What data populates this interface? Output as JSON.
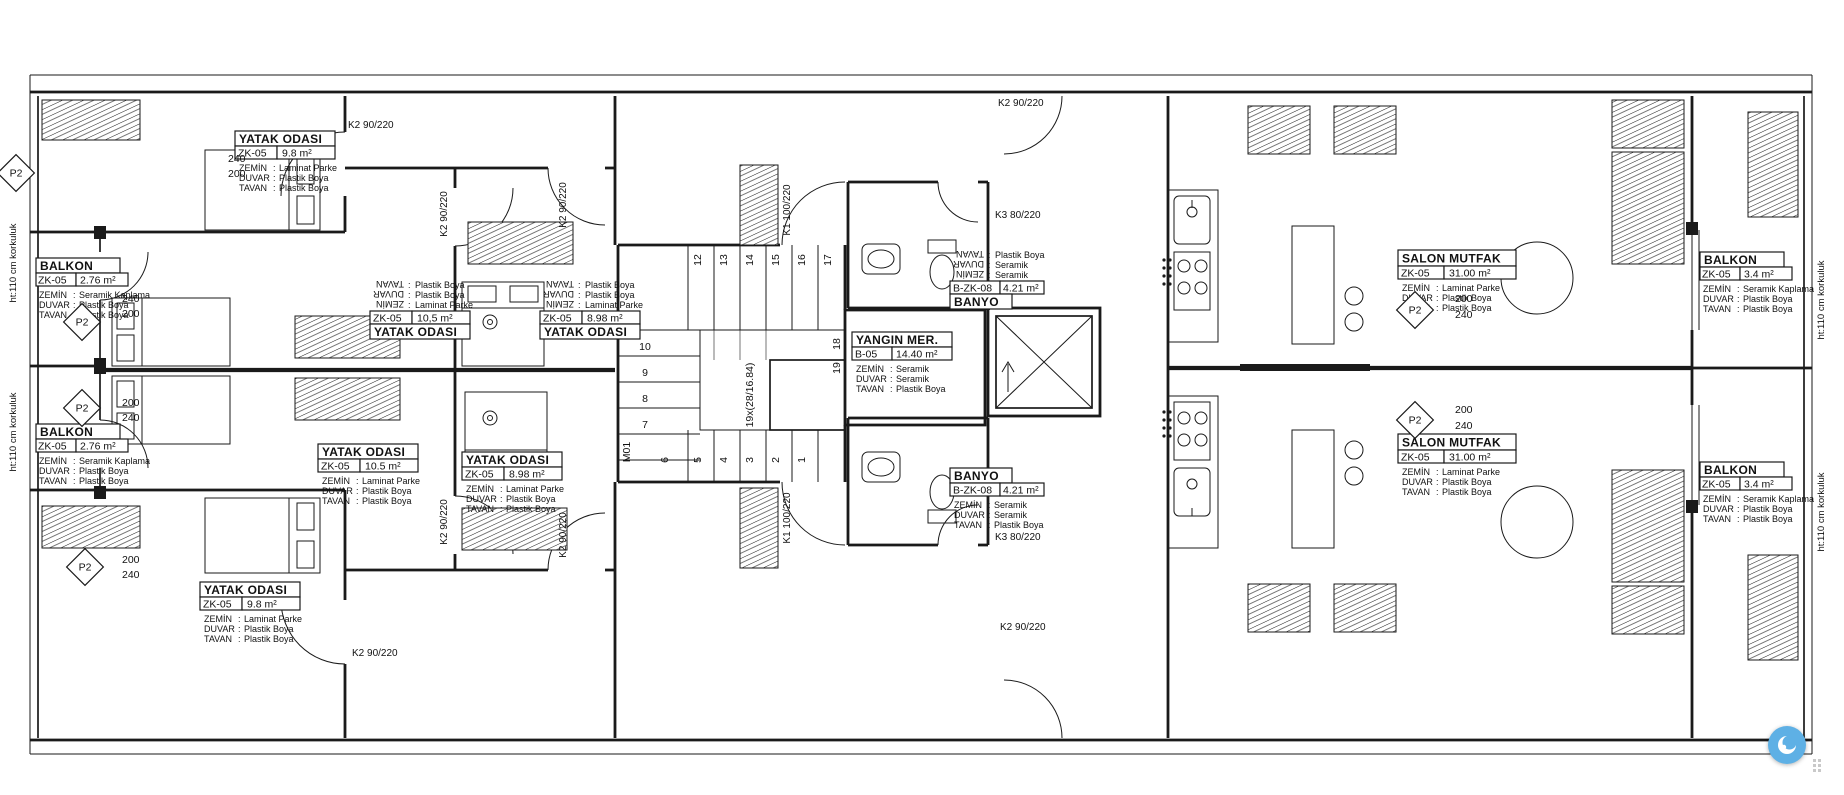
{
  "plan_title": "apartment floor plan",
  "colors": {
    "line": "#1a1a1a",
    "widget_accent": "#5eb0e5"
  },
  "field_labels": {
    "zemin": "ZEMİN",
    "duvar": "DUVAR",
    "tavan": "TAVAN",
    "colon": ":"
  },
  "rooms": [
    {
      "name": "YATAK ODASI",
      "code": "ZK-05",
      "area": "9.8 m²",
      "zemin": "Laminat Parke",
      "duvar": "Plastik Boya",
      "tavan": "Plastik Boya"
    },
    {
      "name": "BALKON",
      "code": "ZK-05",
      "area": "2.76 m²",
      "zemin": "Seramik Kaplama",
      "duvar": "Plastik Boya",
      "tavan": "Plastik Boya"
    },
    {
      "name": "YATAK ODASI",
      "code": "ZK-05",
      "area": "10,5 m²",
      "zemin": "Laminat Parke",
      "duvar": "Plastik Boya",
      "tavan": "Plastik Boya"
    },
    {
      "name": "YATAK ODASI",
      "code": "ZK-05",
      "area": "8.98 m²",
      "zemin": "Laminat Parke",
      "duvar": "Plastik Boya",
      "tavan": "Plastik Boya"
    },
    {
      "name": "BANYO",
      "code": "B-ZK-08",
      "area": "4.21 m²",
      "zemin": "Seramik",
      "duvar": "Seramik",
      "tavan": "Plastik Boya"
    },
    {
      "name": "YANGIN MER.",
      "code": "B-05",
      "area": "14.40 m²",
      "zemin": "Seramik",
      "duvar": "Seramik",
      "tavan": "Plastik Boya"
    },
    {
      "name": "SALON MUTFAK",
      "code": "ZK-05",
      "area": "31.00 m²",
      "zemin": "Laminat Parke",
      "duvar": "Plastik Boya",
      "tavan": "Plastik Boya"
    },
    {
      "name": "BALKON",
      "code": "ZK-05",
      "area": "3.4 m²",
      "zemin": "Seramik Kaplama",
      "duvar": "Plastik Boya",
      "tavan": "Plastik Boya"
    },
    {
      "name": "BALKON",
      "code": "ZK-05",
      "area": "2.76 m²",
      "zemin": "Seramik Kaplama",
      "duvar": "Plastik Boya",
      "tavan": "Plastik Boya"
    },
    {
      "name": "YATAK ODASI",
      "code": "ZK-05",
      "area": "10.5 m²",
      "zemin": "Laminat Parke",
      "duvar": "Plastik Boya",
      "tavan": "Plastik Boya"
    },
    {
      "name": "YATAK ODASI",
      "code": "ZK-05",
      "area": "8.98 m²",
      "zemin": "Laminat Parke",
      "duvar": "Plastik Boya",
      "tavan": "Plastik Boya"
    },
    {
      "name": "BANYO",
      "code": "B-ZK-08",
      "area": "4.21 m²",
      "zemin": "Seramik",
      "duvar": "Seramik",
      "tavan": "Plastik Boya"
    },
    {
      "name": "YATAK ODASI",
      "code": "ZK-05",
      "area": "9.8 m²",
      "zemin": "Laminat Parke",
      "duvar": "Plastik Boya",
      "tavan": "Plastik Boya"
    },
    {
      "name": "SALON MUTFAK",
      "code": "ZK-05",
      "area": "31.00 m²",
      "zemin": "Laminat Parke",
      "duvar": "Plastik Boya",
      "tavan": "Plastik Boya"
    },
    {
      "name": "BALKON",
      "code": "ZK-05",
      "area": "3.4 m²",
      "zemin": "Seramik Kaplama",
      "duvar": "Plastik Boya",
      "tavan": "Plastik Boya"
    }
  ],
  "doors": {
    "k2": "K2  90/220",
    "k1": "K1  100/220",
    "k3": "K3  80/220"
  },
  "dims": {
    "d240": "240",
    "d200": "200"
  },
  "stairs": {
    "note": "19x(28/16.84)",
    "m01": "M01",
    "top": [
      "12",
      "13",
      "14",
      "15",
      "16",
      "17"
    ],
    "left": [
      "10",
      "9",
      "8",
      "7"
    ],
    "bottom": [
      "6",
      "5",
      "4",
      "3",
      "2",
      "1"
    ],
    "fire": [
      "18",
      "19"
    ]
  },
  "railing_note": "ht:110 cm korkuluk",
  "p2": "P2"
}
